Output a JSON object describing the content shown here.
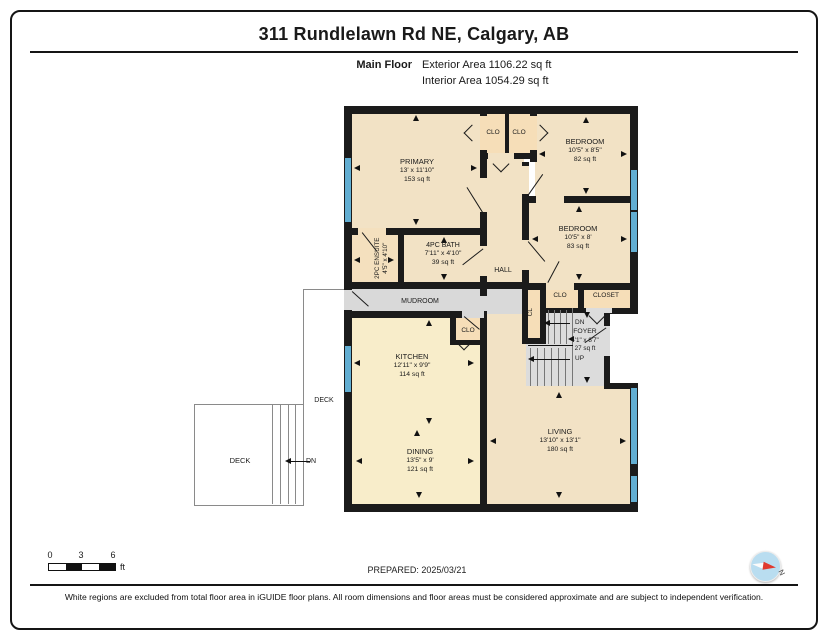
{
  "header": {
    "title": "311 Rundlelawn Rd NE, Calgary, AB",
    "floor_label": "Main Floor",
    "exterior_area": "Exterior Area 1106.22 sq ft",
    "interior_area": "Interior Area 1054.29 sq ft"
  },
  "plan": {
    "rooms": {
      "primary": {
        "name": "PRIMARY",
        "dims": "13' x 11'10\"",
        "area": "153 sq ft"
      },
      "clo_top_a": {
        "name": "CLO"
      },
      "clo_top_b": {
        "name": "CLO"
      },
      "bedroom_a": {
        "name": "BEDROOM",
        "dims": "10'5\" x 8'5\"",
        "area": "82 sq ft"
      },
      "bedroom_b": {
        "name": "BEDROOM",
        "dims": "10'5\" x 8'",
        "area": "83 sq ft"
      },
      "ensuite": {
        "name": "2PC ENSUITE",
        "dims": "4'5\" x 4'10\""
      },
      "bath": {
        "name": "4PC BATH",
        "dims": "7'11\" x 4'10\"",
        "area": "39 sq ft"
      },
      "hall": {
        "name": "HALL"
      },
      "mudroom": {
        "name": "MUDROOM"
      },
      "clo_kitchen": {
        "name": "CLO"
      },
      "clo_bed": {
        "name": "CLO"
      },
      "cl": {
        "name": "CL"
      },
      "closet": {
        "name": "CLOSET"
      },
      "foyer": {
        "name": "FOYER",
        "dims": "4'1\" x 8'7\"",
        "area": "27 sq ft"
      },
      "kitchen": {
        "name": "KITCHEN",
        "dims": "12'11\" x 9'9\"",
        "area": "114 sq ft"
      },
      "dining": {
        "name": "DINING",
        "dims": "13'5\" x 9'",
        "area": "121 sq ft"
      },
      "living": {
        "name": "LIVING",
        "dims": "13'10\" x 13'1\"",
        "area": "180 sq ft"
      },
      "deck_left": {
        "name": "DECK"
      },
      "deck_strip": {
        "name": "DECK"
      }
    },
    "stairs": {
      "down_label": "DN",
      "up_label": "UP"
    },
    "deck_steps_label": "DN"
  },
  "scale_bar": {
    "tick_0": "0",
    "tick_3": "3",
    "tick_6": "6",
    "unit": "ft"
  },
  "prepared_label": "PREPARED: 2025/03/21",
  "compass": {
    "north_label": "N"
  },
  "footer_note": "White regions are excluded from total floor area in iGUIDE floor plans. All room dimensions and floor areas must be considered approximate and are subject to independent verification.",
  "colors": {
    "wall": "#1b1b1b",
    "room_fill": "#f2e2c5",
    "kitchen_fill": "#f8edca",
    "closet_fill": "#f6deb8",
    "utility_gray": "#d9d9d9",
    "window_blue": "#62aed2",
    "needle_red": "#e03a2f",
    "compass_face": "#b9ddf0"
  }
}
